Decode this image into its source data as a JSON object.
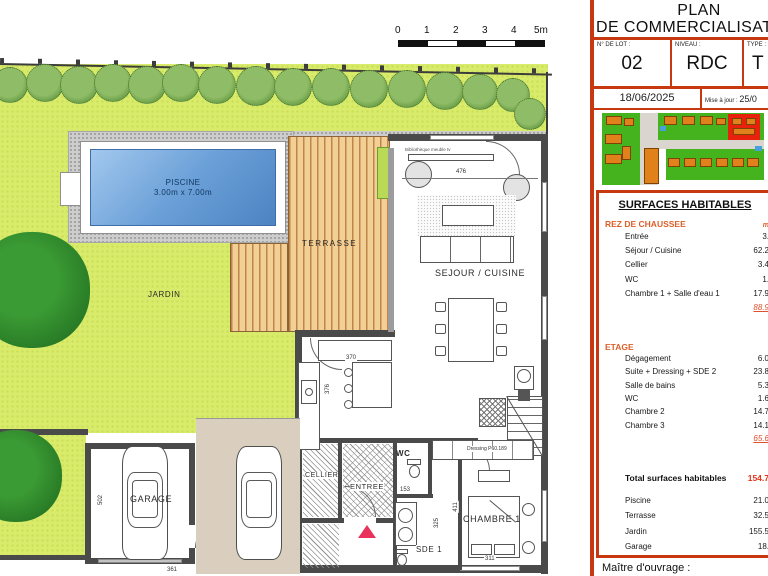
{
  "scalebar": {
    "ticks": [
      "0",
      "1",
      "2",
      "3",
      "4",
      "5m"
    ]
  },
  "plan": {
    "labels": {
      "jardin": "JARDIN",
      "piscine": "PISCINE",
      "piscine_dims": "3.00m x 7.00m",
      "terrasse": "TERRASSE",
      "sejour": "SEJOUR / CUISINE",
      "biblio": "Bibliothèque meuble tv",
      "garage": "GARAGE",
      "cellier": "CELLIER",
      "entree": "ENTREE",
      "wc": "WC",
      "sde": "SDE 1",
      "chambre1": "CHAMBRE 1",
      "dressing": "Dressing P60.189"
    },
    "dimensions": {
      "sejour_w": "476",
      "kitchen_w": "370",
      "kitchen_h": "376",
      "wc_w": "153",
      "chambre_h": "411",
      "sde_h": "325",
      "chambre_w": "311",
      "garage_h": "502",
      "garage_w": "361"
    }
  },
  "panel": {
    "title_line1": "PLAN",
    "title_line2": "DE COMMERCIALISATION",
    "lot_label": "N° DE LOT :",
    "lot_value": "02",
    "niveau_label": "NIVEAU :",
    "niveau_value": "RDC",
    "type_label": "TYPE :",
    "type_value": "T",
    "date": "18/06/2025",
    "maj_label": "Mise à jour :",
    "maj_value": "25/0",
    "surfaces_title": "SURFACES HABITABLES",
    "unit": "m",
    "rdc": {
      "title": "REZ DE CHAUSSEE",
      "rows": [
        {
          "label": "Entrée",
          "value": "3."
        },
        {
          "label": "Séjour / Cuisine",
          "value": "62.2"
        },
        {
          "label": "Cellier",
          "value": "3.4"
        },
        {
          "label": "WC",
          "value": "1."
        },
        {
          "label": "Chambre 1 + Salle d'eau 1",
          "value": "17.9"
        }
      ],
      "subtotal": "88.9"
    },
    "etage": {
      "title": "ETAGE",
      "rows": [
        {
          "label": "Dégagement",
          "value": "6.0"
        },
        {
          "label": "Suite + Dressing + SDE 2",
          "value": "23.8"
        },
        {
          "label": "Salle de bains",
          "value": "5.3"
        },
        {
          "label": "WC",
          "value": "1.6"
        },
        {
          "label": "Chambre 2",
          "value": "14.7"
        },
        {
          "label": "Chambre 3",
          "value": "14.1"
        }
      ],
      "subtotal": "65.6"
    },
    "total_label": "Total surfaces habitables",
    "total_value": "154.7",
    "annex": [
      {
        "label": "Piscine",
        "value": "21.0"
      },
      {
        "label": "Terrasse",
        "value": "32.5"
      },
      {
        "label": "Jardin",
        "value": "155.5"
      },
      {
        "label": "Garage",
        "value": "18."
      }
    ],
    "footer": "Maître d'ouvrage :"
  }
}
